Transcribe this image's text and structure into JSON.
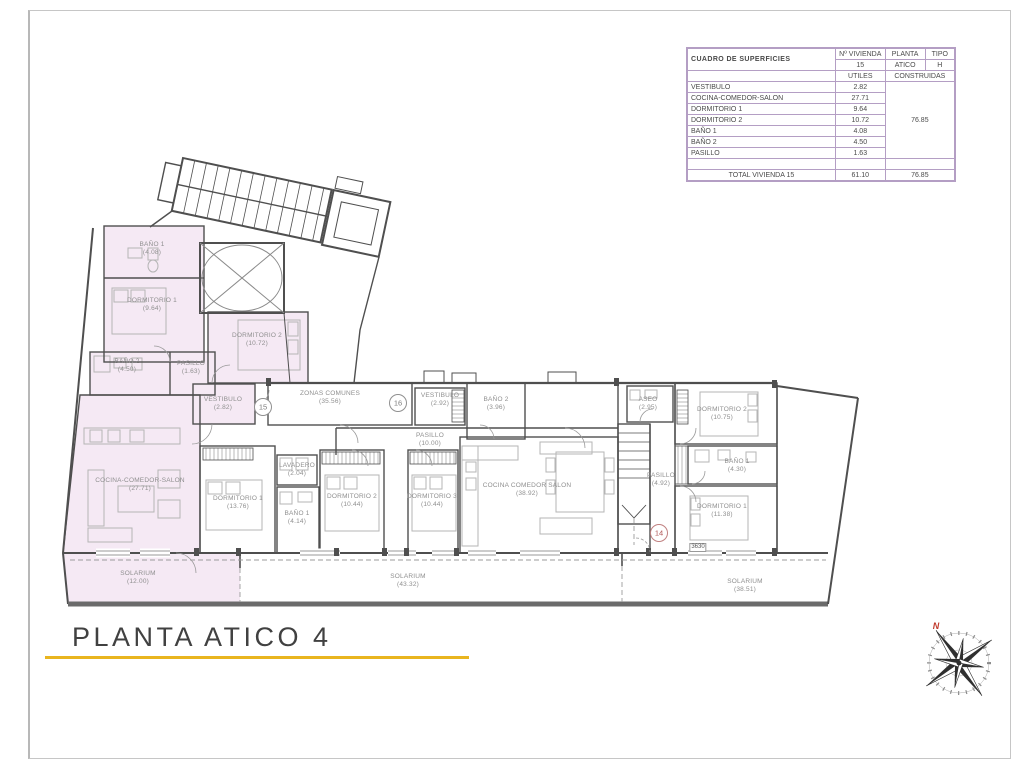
{
  "table": {
    "title": "CUADRO DE SUPERFICIES",
    "header": {
      "vivienda_label": "Nº VIVIENDA",
      "vivienda_value": "15",
      "planta_label": "PLANTA",
      "planta_value": "ATICO",
      "tipo_label": "TIPO",
      "tipo_value": "H"
    },
    "columns": {
      "utiles": "UTILES",
      "construidas": "CONSTRUIDAS"
    },
    "rows": [
      {
        "name": "VESTIBULO",
        "utiles": "2.82"
      },
      {
        "name": "COCINA-COMEDOR-SALON",
        "utiles": "27.71"
      },
      {
        "name": "DORMITORIO 1",
        "utiles": "9.64"
      },
      {
        "name": "DORMITORIO 2",
        "utiles": "10.72"
      },
      {
        "name": "BAÑO 1",
        "utiles": "4.08"
      },
      {
        "name": "BAÑO 2",
        "utiles": "4.50"
      },
      {
        "name": "PASILLO",
        "utiles": "1.63"
      }
    ],
    "construidas_value": "76.85",
    "total": {
      "label": "TOTAL VIVIENDA 15",
      "utiles": "61.10",
      "construidas": "76.85"
    }
  },
  "plan": {
    "rooms": {
      "u15_bano1": {
        "name": "BAÑO 1",
        "area": "(4.08)"
      },
      "u15_dorm1": {
        "name": "DORMITORIO 1",
        "area": "(9.64)"
      },
      "u15_dorm2": {
        "name": "DORMITORIO 2",
        "area": "(10.72)"
      },
      "u15_bano2": {
        "name": "BAÑO 2",
        "area": "(4.50)"
      },
      "u15_pasillo": {
        "name": "PASILLO",
        "area": "(1.63)"
      },
      "u15_vestibulo": {
        "name": "VESTIBULO",
        "area": "(2.82)"
      },
      "u15_salon": {
        "name": "COCINA-COMEDOR-SALON",
        "area": "(27.71)"
      },
      "u15_solarium": {
        "name": "SOLARIUM",
        "area": "(12.00)"
      },
      "zonas": {
        "name": "ZONAS COMUNES",
        "area": "(35.56)"
      },
      "u16_vestibulo": {
        "name": "VESTIBULO",
        "area": "(2.92)"
      },
      "u16_bano2": {
        "name": "BAÑO 2",
        "area": "(3.96)"
      },
      "u16_pasillo": {
        "name": "PASILLO",
        "area": "(10.00)"
      },
      "u16_lavadero": {
        "name": "LAVADERO",
        "area": "(2.04)"
      },
      "u16_dorm1": {
        "name": "DORMITORIO 1",
        "area": "(13.76)"
      },
      "u16_bano1": {
        "name": "BAÑO 1",
        "area": "(4.14)"
      },
      "u16_dorm2": {
        "name": "DORMITORIO 2",
        "area": "(10.44)"
      },
      "u16_dorm3": {
        "name": "DORMITORIO 3",
        "area": "(10.44)"
      },
      "u16_salon": {
        "name": "COCINA COMEDOR SALON",
        "area": "(38.92)"
      },
      "u16_solarium": {
        "name": "SOLARIUM",
        "area": "(43.32)"
      },
      "u14_aseo": {
        "name": "ASEO",
        "area": "(2.95)"
      },
      "u14_dorm2": {
        "name": "DORMITORIO 2",
        "area": "(10.75)"
      },
      "u14_pasillo": {
        "name": "PASILLO",
        "area": "(4.92)"
      },
      "u14_bano1": {
        "name": "BAÑO 1",
        "area": "(4.30)"
      },
      "u14_dorm1": {
        "name": "DORMITORIO 1",
        "area": "(11.38)"
      },
      "u14_solarium": {
        "name": "SOLARIUM",
        "area": "(38.51)"
      }
    },
    "badges": {
      "b15": "15",
      "b16": "16",
      "b14": "14"
    },
    "dimension": "3630",
    "compass_north": "N"
  },
  "footer": {
    "title": "PLANTA ATICO 4"
  },
  "colors": {
    "accent_gold": "#E9B51F",
    "unit_highlight_fill": "#F5E9F4",
    "badge_red": "#C0392B",
    "wall_gray": "#4F4F4F",
    "table_border_purple": "#B49EC4"
  }
}
